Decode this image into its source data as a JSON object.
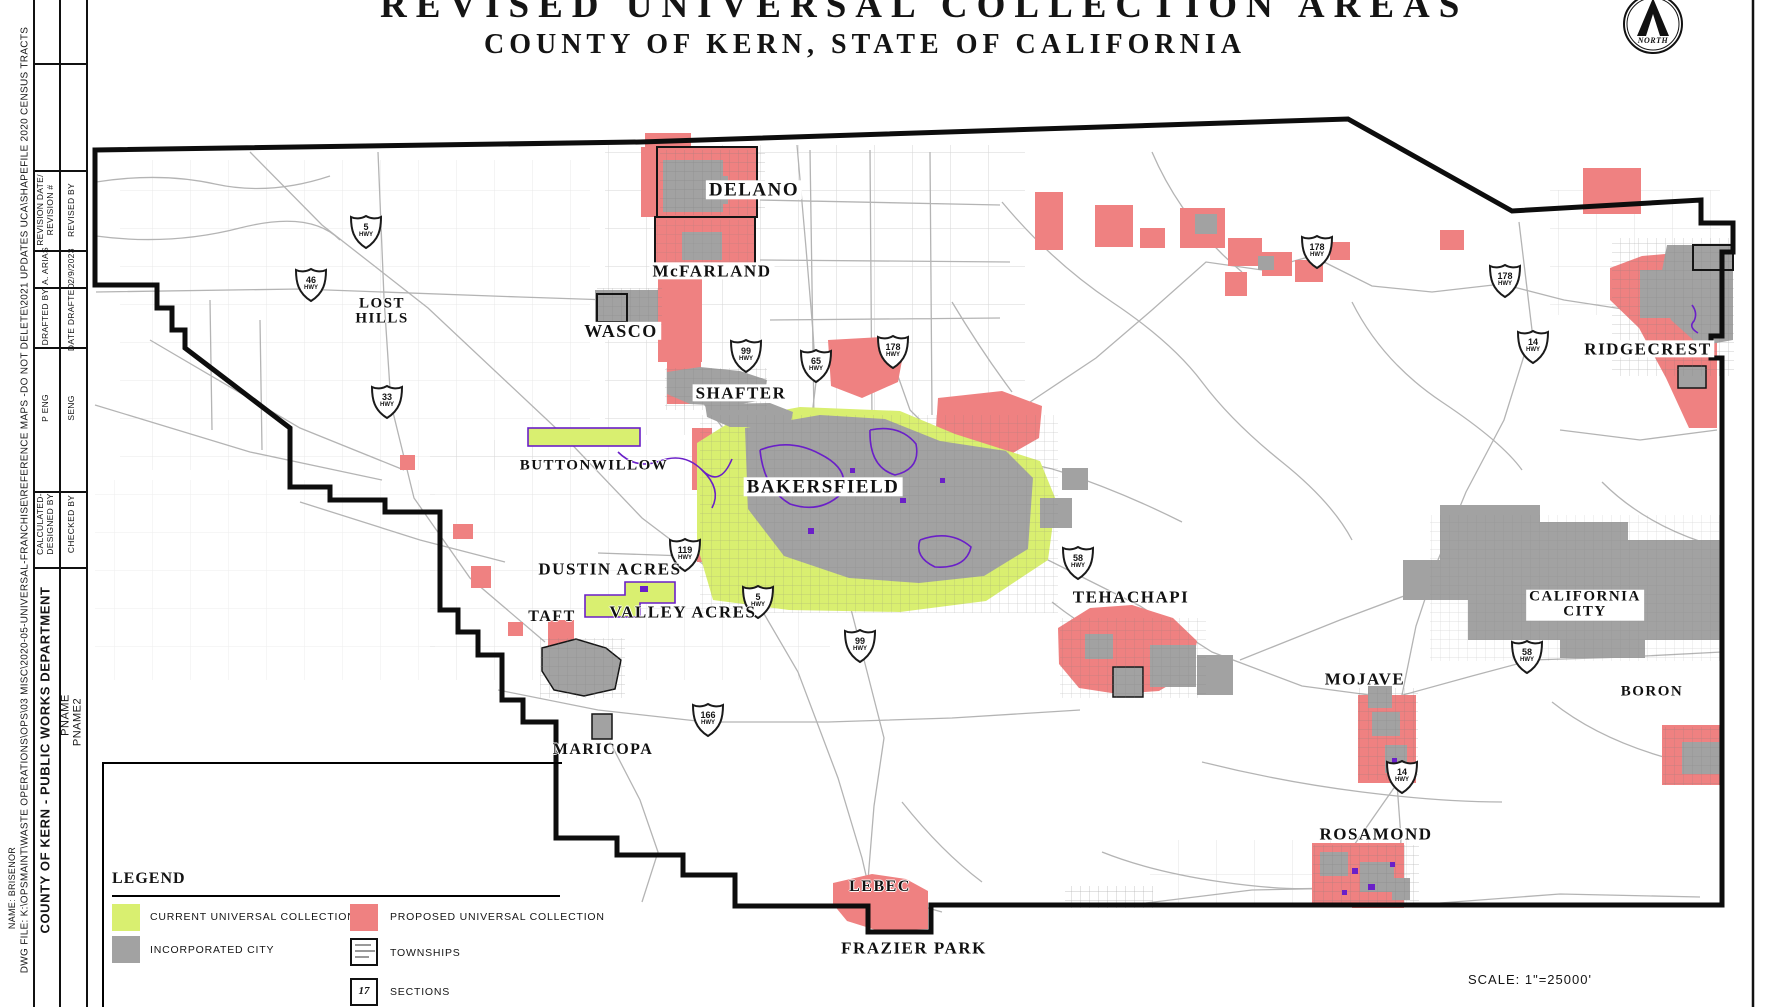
{
  "colors": {
    "red": "#ef8181",
    "yellow": "#d9ef70",
    "gray": "#a2a2a2",
    "purple": "#6a1fc8",
    "road": "#b4b4b4",
    "boundary": "#0d0d0d",
    "blue": "#2f6bf0"
  },
  "title": {
    "line1": "REVISED UNIVERSAL COLLECTION AREAS",
    "line2": "COUNTY OF KERN, STATE OF CALIFORNIA"
  },
  "page": {
    "scale_text": "SCALE: 1\"=25000'",
    "north_label": "NORTH"
  },
  "title_block": {
    "dwg_file": "DWG FILE: K:\\OPSMAINT\\WASTE OPERATIONS\\OPS\\03 MISC\\2020-05-UNIVERSAL-FRANCHISE\\REFERENCE MAPS -DO NOT DELETE\\2021 UPDATES UCA\\SHAPEFILE 2020 CENSUS TRACTS",
    "name": "NAME: BRISENOR",
    "department": "COUNTY OF KERN  -  PUBLIC WORKS DEPARTMENT",
    "pname": "PNAME",
    "pname2": "PNAME2",
    "rows": [
      {
        "left": "REVISION DATE/\nREVISION #",
        "right": "REVISED BY"
      },
      {
        "left": "A. ARIAS",
        "right": "2/9/2023"
      },
      {
        "left": "DRAFTED BY",
        "right": "DATE DRAFTED"
      },
      {
        "left": "P ENG",
        "right": "SENG"
      },
      {
        "left": "CALCULATED-\nDESIGNED BY",
        "right": "CHECKED BY"
      }
    ]
  },
  "legend": {
    "heading": "LEGEND",
    "items": [
      {
        "key": "current",
        "label": "CURRENT UNIVERSAL COLLECTION"
      },
      {
        "key": "incorporated",
        "label": "INCORPORATED CITY"
      },
      {
        "key": "proposed",
        "label": "PROPOSED UNIVERSAL COLLECTION"
      },
      {
        "key": "townships",
        "label": "TOWNSHIPS"
      },
      {
        "key": "sections",
        "label": "SECTIONS",
        "number": "17"
      }
    ]
  },
  "map": {
    "cities": [
      {
        "name": "DELANO",
        "x": 754,
        "y": 190,
        "size": 19,
        "bg": true
      },
      {
        "name": "McFARLAND",
        "x": 712,
        "y": 271,
        "size": 17,
        "bg": true
      },
      {
        "name": "WASCO",
        "x": 621,
        "y": 331,
        "size": 18,
        "bg": true
      },
      {
        "name": "LOST HILLS",
        "x": 382,
        "y": 312,
        "size": 15,
        "lines": [
          "LOST",
          "HILLS"
        ]
      },
      {
        "name": "SHAFTER",
        "x": 741,
        "y": 393,
        "size": 17,
        "bg": true
      },
      {
        "name": "BUTTONWILLOW",
        "x": 594,
        "y": 466,
        "size": 15
      },
      {
        "name": "BAKERSFIELD",
        "x": 823,
        "y": 487,
        "size": 19,
        "bg": true
      },
      {
        "name": "DUSTIN ACRES",
        "x": 610,
        "y": 569,
        "size": 17
      },
      {
        "name": "VALLEY ACRES",
        "x": 683,
        "y": 612,
        "size": 17
      },
      {
        "name": "TAFT",
        "x": 552,
        "y": 617,
        "size": 16
      },
      {
        "name": "MARICOPA",
        "x": 603,
        "y": 750,
        "size": 16
      },
      {
        "name": "TEHACHAPI",
        "x": 1131,
        "y": 597,
        "size": 17
      },
      {
        "name": "MOJAVE",
        "x": 1365,
        "y": 679,
        "size": 17
      },
      {
        "name": "CALIFORNIA CITY",
        "x": 1585,
        "y": 605,
        "size": 15,
        "bg": true,
        "lines": [
          "CALIFORNIA",
          "CITY"
        ]
      },
      {
        "name": "BORON",
        "x": 1652,
        "y": 692,
        "size": 15
      },
      {
        "name": "RIDGECREST",
        "x": 1648,
        "y": 349,
        "size": 17,
        "bg": true
      },
      {
        "name": "ROSAMOND",
        "x": 1376,
        "y": 834,
        "size": 17
      },
      {
        "name": "LEBEC",
        "x": 880,
        "y": 887,
        "size": 16
      },
      {
        "name": "FRAZIER PARK",
        "x": 914,
        "y": 948,
        "size": 17
      }
    ],
    "shields": [
      {
        "route": "5",
        "x": 366,
        "y": 232
      },
      {
        "route": "46",
        "x": 311,
        "y": 285
      },
      {
        "route": "33",
        "x": 387,
        "y": 402
      },
      {
        "route": "99",
        "x": 746,
        "y": 356
      },
      {
        "route": "65",
        "x": 816,
        "y": 366
      },
      {
        "route": "178",
        "x": 893,
        "y": 352
      },
      {
        "route": "119",
        "x": 685,
        "y": 555
      },
      {
        "route": "5",
        "x": 758,
        "y": 602
      },
      {
        "route": "99",
        "x": 860,
        "y": 646
      },
      {
        "route": "166",
        "x": 708,
        "y": 720
      },
      {
        "route": "58",
        "x": 1078,
        "y": 563
      },
      {
        "route": "58",
        "x": 1527,
        "y": 657
      },
      {
        "route": "14",
        "x": 1402,
        "y": 777
      },
      {
        "route": "178",
        "x": 1317,
        "y": 252
      },
      {
        "route": "178",
        "x": 1505,
        "y": 281
      },
      {
        "route": "14",
        "x": 1533,
        "y": 347
      }
    ]
  }
}
